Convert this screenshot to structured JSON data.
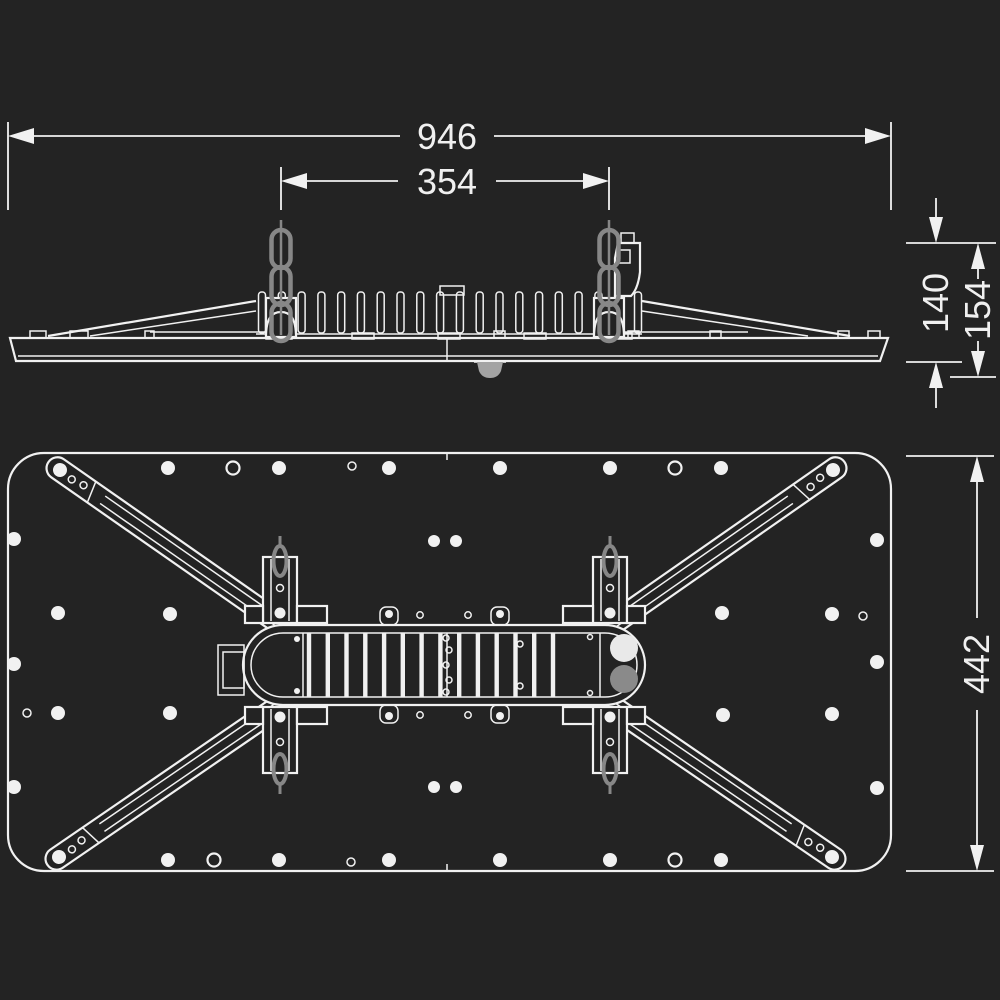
{
  "figure": {
    "kind": "technical-dimension-drawing",
    "views": [
      "side-elevation",
      "underside-plan"
    ]
  },
  "colors": {
    "background": "#232323",
    "line": "#f1f1f1",
    "chain_gray": "#878787",
    "port_white": "#e9e9e9",
    "port_gray": "#8a8a8a",
    "sensor_gray": "#a3a3a3"
  },
  "dimensions": {
    "overall_width": "946",
    "suspension_spacing": "354",
    "body_height": "140",
    "overall_height": "154",
    "body_depth": "442"
  }
}
